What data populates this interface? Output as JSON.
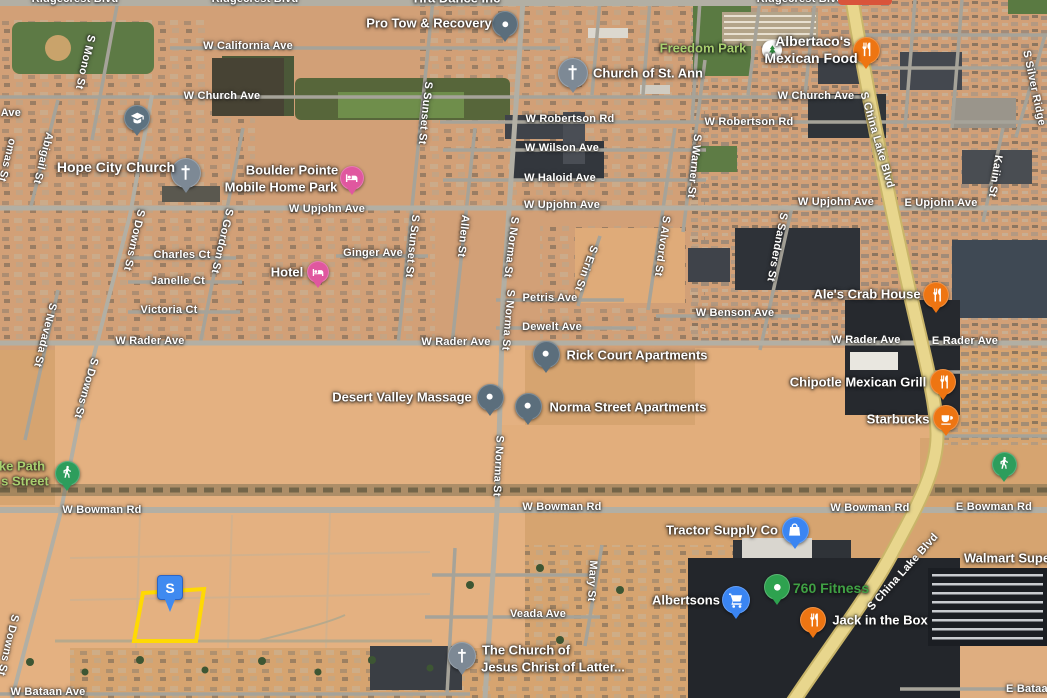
{
  "map": {
    "view": "satellite-oblique",
    "palette": {
      "desert_base": "#d6a470",
      "desert_open": "#e4b181",
      "road_gray": "#a6a399",
      "major_road_gray": "#b2afa4",
      "highway_yellow": "#e8d68d",
      "parcel_outline_yellow": "#ffd903",
      "marker_blue": "#3f8af0",
      "park_label_green": "#a9d06f",
      "business_label_green": "#3fa044",
      "pin_restaurant_orange": "#ee7512",
      "pin_generic_slate": "#5b6e7c",
      "pin_church_gray": "#7d8995",
      "pin_lodging_pink": "#e0579f",
      "pin_shopping_blue": "#3a85f2",
      "pin_outdoors_green": "#2d9d5c",
      "pin_fitness_green": "#2ea24f",
      "pin_school_slate": "#5d7280",
      "park_icon_white": "#ffffff"
    },
    "street_labels": [
      {
        "text": "Ridgecrest Blvd",
        "x": 75,
        "y": -1,
        "rot": 0
      },
      {
        "text": "Ridgecrest Blvd",
        "x": 255,
        "y": -1,
        "rot": 0
      },
      {
        "text": "Ridgecrest Blvd",
        "x": 800,
        "y": -1,
        "rot": 0
      },
      {
        "text": "W California Ave",
        "x": 248,
        "y": 46,
        "rot": 0
      },
      {
        "text": "W Church Ave",
        "x": 222,
        "y": 96,
        "rot": 0
      },
      {
        "text": "W Church Ave",
        "x": 816,
        "y": 96,
        "rot": 0
      },
      {
        "text": "W Robertson Rd",
        "x": 570,
        "y": 119,
        "rot": 0
      },
      {
        "text": "W Robertson Rd",
        "x": 749,
        "y": 122,
        "rot": 0
      },
      {
        "text": "W Wilson Ave",
        "x": 562,
        "y": 148,
        "rot": 0
      },
      {
        "text": "W Haloid Ave",
        "x": 560,
        "y": 178,
        "rot": 0
      },
      {
        "text": "W Upjohn Ave",
        "x": 327,
        "y": 209,
        "rot": 0
      },
      {
        "text": "W Upjohn Ave",
        "x": 562,
        "y": 205,
        "rot": 0
      },
      {
        "text": "W Upjohn Ave",
        "x": 836,
        "y": 202,
        "rot": 0
      },
      {
        "text": "E Upjohn Ave",
        "x": 941,
        "y": 203,
        "rot": 0
      },
      {
        "text": "Charles Ct",
        "x": 182,
        "y": 255,
        "rot": 0
      },
      {
        "text": "Ginger Ave",
        "x": 373,
        "y": 253,
        "rot": 0
      },
      {
        "text": "Janelle Ct",
        "x": 178,
        "y": 281,
        "rot": 0
      },
      {
        "text": "Victoria Ct",
        "x": 169,
        "y": 310,
        "rot": 0
      },
      {
        "text": "Petris Ave",
        "x": 550,
        "y": 298,
        "rot": 0
      },
      {
        "text": "Dewelt Ave",
        "x": 552,
        "y": 327,
        "rot": 0
      },
      {
        "text": "W Rader Ave",
        "x": 150,
        "y": 341,
        "rot": 0
      },
      {
        "text": "W Rader Ave",
        "x": 456,
        "y": 342,
        "rot": 0
      },
      {
        "text": "W Rader Ave",
        "x": 866,
        "y": 340,
        "rot": 0
      },
      {
        "text": "E Rader Ave",
        "x": 965,
        "y": 341,
        "rot": 0
      },
      {
        "text": "W Benson Ave",
        "x": 735,
        "y": 313,
        "rot": 0
      },
      {
        "text": "W Bowman Rd",
        "x": 102,
        "y": 510,
        "rot": 0
      },
      {
        "text": "W Bowman Rd",
        "x": 562,
        "y": 507,
        "rot": 0
      },
      {
        "text": "W Bowman Rd",
        "x": 870,
        "y": 508,
        "rot": 0
      },
      {
        "text": "E Bowman Rd",
        "x": 994,
        "y": 507,
        "rot": 0
      },
      {
        "text": "Veada Ave",
        "x": 538,
        "y": 614,
        "rot": 0
      },
      {
        "text": "W Bataan Ave",
        "x": 48,
        "y": 692,
        "rot": 0
      },
      {
        "text": "E Bataan Ave",
        "x": 1042,
        "y": 689,
        "rot": 0
      },
      {
        "text": "S Mono St",
        "x": 85,
        "y": 62,
        "rot": 103
      },
      {
        "text": "d Ave",
        "x": 6,
        "y": 113,
        "rot": 0
      },
      {
        "text": "omas St",
        "x": 7,
        "y": 160,
        "rot": 104
      },
      {
        "text": "Abigail St",
        "x": 43,
        "y": 158,
        "rot": 104
      },
      {
        "text": "S Downs St",
        "x": 134,
        "y": 240,
        "rot": 103
      },
      {
        "text": "S Downs St",
        "x": 86,
        "y": 388,
        "rot": 106
      },
      {
        "text": "S Downs St",
        "x": 8,
        "y": 645,
        "rot": 103
      },
      {
        "text": "S Nevada St",
        "x": 45,
        "y": 335,
        "rot": 104
      },
      {
        "text": "S Gordon St",
        "x": 222,
        "y": 241,
        "rot": 103
      },
      {
        "text": "S Sunset St",
        "x": 425,
        "y": 113,
        "rot": 96
      },
      {
        "text": "S Sunset St",
        "x": 412,
        "y": 246,
        "rot": 96
      },
      {
        "text": "Allen St",
        "x": 463,
        "y": 236,
        "rot": 96
      },
      {
        "text": "S Norma St",
        "x": 511,
        "y": 247,
        "rot": 97
      },
      {
        "text": "S Norma St",
        "x": 508,
        "y": 320,
        "rot": 95
      },
      {
        "text": "S Norma St",
        "x": 498,
        "y": 466,
        "rot": 93
      },
      {
        "text": "S Erin St",
        "x": 586,
        "y": 268,
        "rot": 110
      },
      {
        "text": "Mary St",
        "x": 592,
        "y": 581,
        "rot": 93
      },
      {
        "text": "S Alvord St",
        "x": 662,
        "y": 246,
        "rot": 98
      },
      {
        "text": "S Warner St",
        "x": 694,
        "y": 166,
        "rot": 96
      },
      {
        "text": "S Sanders St",
        "x": 777,
        "y": 247,
        "rot": 101
      },
      {
        "text": "Kaiin St",
        "x": 995,
        "y": 176,
        "rot": 99
      },
      {
        "text": "S Silver Ridge",
        "x": 1034,
        "y": 88,
        "rot": 78
      },
      {
        "text": "S China Lake Blvd",
        "x": 877,
        "y": 140,
        "rot": 74
      },
      {
        "text": "S China Lake Blvd",
        "x": 903,
        "y": 572,
        "rot": -48
      }
    ],
    "pois": [
      {
        "id": "pro-tow-recovery",
        "icon": "dot",
        "color": "#5b6e7c",
        "pin": {
          "x": 505,
          "y": 24,
          "size": 26
        },
        "lines": [
          {
            "text": "Pro Tow & Recovery",
            "x": 429,
            "y": 23
          }
        ]
      },
      {
        "id": "church-of-st-ann",
        "icon": "church",
        "color": "#7d8995",
        "pin": {
          "x": 573,
          "y": 73,
          "size": 30
        },
        "lines": [
          {
            "text": "Church of St. Ann",
            "x": 648,
            "y": 73
          }
        ]
      },
      {
        "id": "freedom-park",
        "icon": "tree",
        "color": "#ffffff",
        "no_tail": true,
        "pin": {
          "x": 772,
          "y": 50,
          "size": 20
        },
        "label_color": "#a9d06f",
        "lines": [
          {
            "text": "Freedom Park",
            "x": 703,
            "y": 48
          }
        ]
      },
      {
        "id": "albertacos-mexican-food",
        "icon": "restaurant",
        "color": "#ee7512",
        "pin": {
          "x": 866,
          "y": 50,
          "size": 27
        },
        "size": 14,
        "lines": [
          {
            "text": "Albertaco's",
            "x": 813,
            "y": 41
          },
          {
            "text": "Mexican Food",
            "x": 811,
            "y": 58
          }
        ]
      },
      {
        "id": "hope-city-church",
        "icon": "church",
        "color": "#7d8995",
        "pin": {
          "x": 186,
          "y": 173,
          "size": 30
        },
        "size": 14,
        "lines": [
          {
            "text": "Hope City Church",
            "x": 116,
            "y": 167
          }
        ]
      },
      {
        "id": "boulder-pointe-mobile-home-park",
        "icon": "lodging",
        "color": "#e0579f",
        "pin": {
          "x": 352,
          "y": 178,
          "size": 24
        },
        "lines": [
          {
            "text": "Boulder Pointe",
            "x": 292,
            "y": 170
          },
          {
            "text": "Mobile Home Park",
            "x": 281,
            "y": 187
          }
        ]
      },
      {
        "id": "hotel",
        "icon": "lodging",
        "color": "#e0579f",
        "pin": {
          "x": 318,
          "y": 272,
          "size": 22
        },
        "lines": [
          {
            "text": "Hotel",
            "x": 287,
            "y": 272
          }
        ]
      },
      {
        "id": "ales-crab-house",
        "icon": "restaurant",
        "color": "#ee7512",
        "pin": {
          "x": 936,
          "y": 295,
          "size": 26
        },
        "lines": [
          {
            "text": "Ale's Crab House",
            "x": 867,
            "y": 294
          }
        ]
      },
      {
        "id": "rick-court-apartments",
        "icon": "dot",
        "color": "#5b6e7c",
        "pin": {
          "x": 546,
          "y": 354,
          "size": 27
        },
        "lines": [
          {
            "text": "Rick Court Apartments",
            "x": 637,
            "y": 355
          }
        ]
      },
      {
        "id": "desert-valley-massage",
        "icon": "dot",
        "color": "#5b6e7c",
        "pin": {
          "x": 490,
          "y": 397,
          "size": 27
        },
        "lines": [
          {
            "text": "Desert Valley Massage",
            "x": 402,
            "y": 397
          }
        ]
      },
      {
        "id": "norma-street-apartments",
        "icon": "dot",
        "color": "#5b6e7c",
        "pin": {
          "x": 528,
          "y": 406,
          "size": 27
        },
        "lines": [
          {
            "text": "Norma Street Apartments",
            "x": 628,
            "y": 407
          }
        ]
      },
      {
        "id": "chipotle-mexican-grill",
        "icon": "restaurant",
        "color": "#ee7512",
        "pin": {
          "x": 943,
          "y": 382,
          "size": 26
        },
        "lines": [
          {
            "text": "Chipotle Mexican Grill",
            "x": 858,
            "y": 382
          }
        ]
      },
      {
        "id": "starbucks",
        "icon": "coffee",
        "color": "#ee7512",
        "pin": {
          "x": 946,
          "y": 418,
          "size": 26
        },
        "lines": [
          {
            "text": "Starbucks",
            "x": 898,
            "y": 419
          }
        ]
      },
      {
        "id": "bike-path-trailhead",
        "icon": "walker",
        "color": "#2d9d5c",
        "pin": {
          "x": 67,
          "y": 473,
          "size": 25
        },
        "label_color": "#a9d06f",
        "lines": [
          {
            "text": "ke Path",
            "x": 22,
            "y": 466
          },
          {
            "text": "s Street",
            "x": 25,
            "y": 481
          }
        ]
      },
      {
        "id": "tractor-supply-co",
        "icon": "bag",
        "color": "#3a85f2",
        "pin": {
          "x": 795,
          "y": 530,
          "size": 27
        },
        "lines": [
          {
            "text": "Tractor Supply Co",
            "x": 722,
            "y": 530
          }
        ]
      },
      {
        "id": "pedestrian-path-east",
        "icon": "walker",
        "color": "#2d9d5c",
        "pin": {
          "x": 1004,
          "y": 464,
          "size": 25
        },
        "lines": []
      },
      {
        "id": "walmart-supercenter",
        "icon": null,
        "color": null,
        "pin": null,
        "lines": [
          {
            "text": "Walmart Supe",
            "x": 1007,
            "y": 558
          }
        ]
      },
      {
        "id": "albertsons",
        "icon": "cart",
        "color": "#3a85f2",
        "pin": {
          "x": 736,
          "y": 600,
          "size": 28
        },
        "lines": [
          {
            "text": "Albertsons",
            "x": 686,
            "y": 600
          }
        ]
      },
      {
        "id": "760-fitness",
        "icon": "fitness",
        "color": "#2ea24f",
        "pin": {
          "x": 777,
          "y": 587,
          "size": 26
        },
        "size": 14,
        "label_color": "#3fa044",
        "lines": [
          {
            "text": "760 Fitness",
            "x": 831,
            "y": 588
          }
        ]
      },
      {
        "id": "jack-in-the-box",
        "icon": "restaurant",
        "color": "#ee7512",
        "pin": {
          "x": 813,
          "y": 620,
          "size": 26
        },
        "lines": [
          {
            "text": "Jack in the Box",
            "x": 880,
            "y": 620
          }
        ]
      },
      {
        "id": "lds-church",
        "icon": "church",
        "color": "#7d8995",
        "pin": {
          "x": 462,
          "y": 656,
          "size": 28
        },
        "lines": [
          {
            "text": "The Church of",
            "x": 526,
            "y": 650
          },
          {
            "text": "Jesus Christ of Latter...",
            "x": 553,
            "y": 667
          }
        ]
      },
      {
        "id": "school",
        "icon": "school",
        "color": "#5d7280",
        "pin": {
          "x": 137,
          "y": 118,
          "size": 26
        },
        "lines": []
      },
      {
        "id": "tira-dance-inc",
        "icon": null,
        "color": null,
        "pin": null,
        "lines": [
          {
            "text": "Tira Dance Inc",
            "x": 456,
            "y": -2
          }
        ]
      }
    ],
    "parcel": {
      "points": "143,593 204,589 196,641 134,641",
      "stroke_width": 4
    },
    "marker": {
      "label": "S",
      "x": 157,
      "y": 575,
      "width": 24,
      "height": 23
    },
    "partials": [
      {
        "id": "top-edge-cut-poi",
        "x": 838,
        "y": 0,
        "w": 54,
        "h": 5,
        "color": "#d9543b"
      }
    ]
  }
}
